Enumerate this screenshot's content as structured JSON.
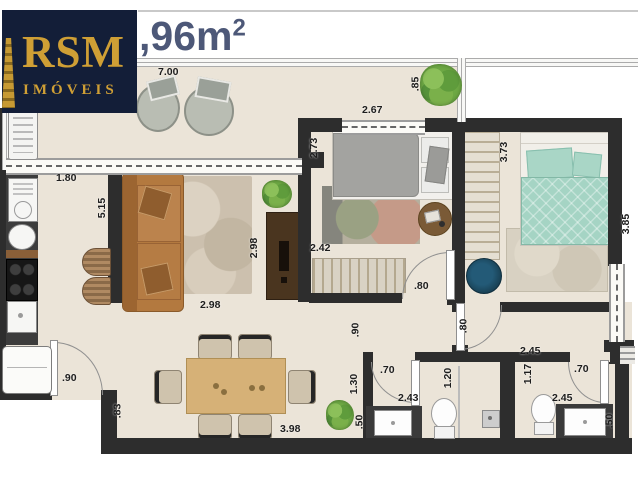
{
  "logo": {
    "brand": "RSM",
    "tagline": "IMÓVEIS"
  },
  "title": {
    "area": ",96m",
    "sup": "2"
  },
  "colors": {
    "logo_bg": "#131e38",
    "logo_gold": "#cf9f35",
    "title_text": "#4d5878",
    "wall": "#2d2d2d",
    "floor": "#ebe4d8",
    "sofa": "#b3793f",
    "teal_bed": "#a5d4c4",
    "navy_rug": "#1e4d66",
    "wood_table": "#d6b177"
  },
  "dims": {
    "balcony_length": "7.00",
    "balcony_right_width": "2.67",
    "balcony_right_depth": ".85",
    "kitchen_width": "1.80",
    "living_length": "5.15",
    "bedroom2_depth": "2.73",
    "bedroom2_closet": "2.42",
    "living_width_v": "2.98",
    "living_width_h": "2.98",
    "entry_door": ".90",
    "entry_wall": ".83",
    "dining_length": "3.98",
    "bedroom2_door": ".80",
    "suite_door": ".80",
    "hall_width": ".90",
    "suite_length": "3.73",
    "suite_width": "3.85",
    "bath1_entry": "1.30",
    "bath1_door": ".70",
    "bath1_width": "2.43",
    "bath1_shower": "1.20",
    "bath1_vanity": ".50",
    "bath2_hall": "2.45",
    "bath2_entry": "1.17",
    "bath2_door": ".70",
    "bath2_width": "2.45",
    "bath2_vanity": ".50"
  }
}
